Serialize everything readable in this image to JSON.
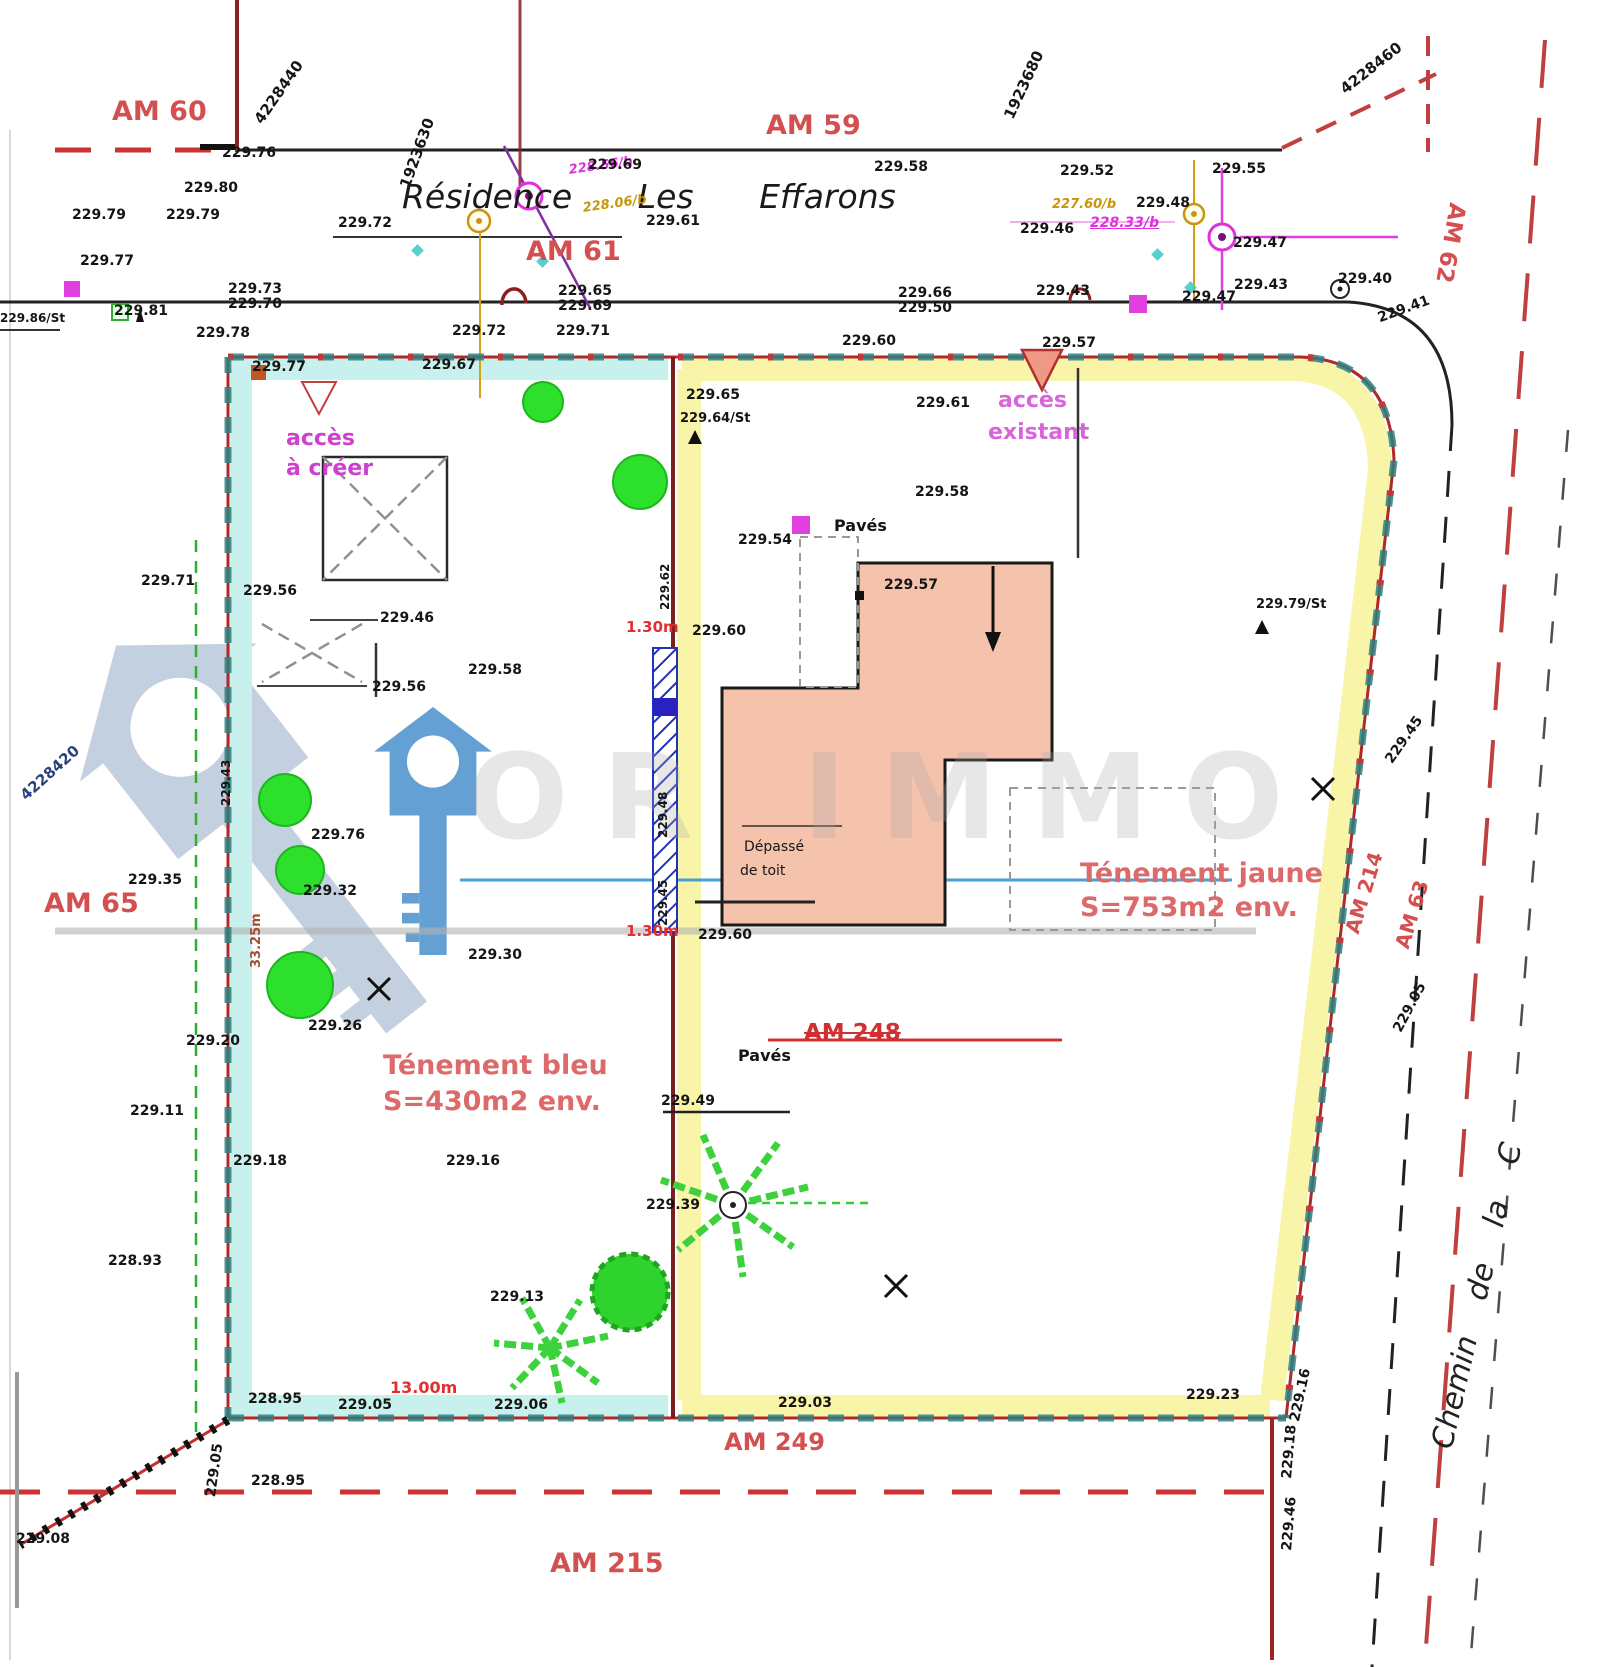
{
  "document": {
    "title": "Plan de division - Résidence Les Effarons"
  },
  "watermark": {
    "text": "OR IMMO"
  },
  "labels": [
    {
      "t": "4228440",
      "x": 252,
      "y": 118,
      "r": -55,
      "s": 15,
      "n": "grid-coordinate"
    },
    {
      "t": "1923630",
      "x": 398,
      "y": 185,
      "r": -70,
      "s": 15,
      "n": "grid-coordinate"
    },
    {
      "t": "1923680",
      "x": 1002,
      "y": 115,
      "r": -65,
      "s": 15,
      "n": "grid-coordinate"
    },
    {
      "t": "4228460",
      "x": 1338,
      "y": 85,
      "r": -38,
      "s": 15,
      "n": "grid-coordinate"
    },
    {
      "t": "4228420",
      "x": 18,
      "y": 792,
      "r": -42,
      "s": 15,
      "c": "#27427a",
      "n": "grid-coordinate"
    },
    {
      "t": "AM 60",
      "x": 112,
      "y": 98,
      "c": "#d45050",
      "s": 27,
      "n": "parcel-label-am60"
    },
    {
      "t": "AM 59",
      "x": 766,
      "y": 112,
      "c": "#d45050",
      "s": 27,
      "n": "parcel-label-am59"
    },
    {
      "t": "AM 61",
      "x": 526,
      "y": 238,
      "c": "#d45050",
      "s": 27,
      "n": "parcel-label-am61"
    },
    {
      "t": "AM 65",
      "x": 44,
      "y": 890,
      "c": "#d45050",
      "s": 27,
      "n": "parcel-label-am65"
    },
    {
      "t": "AM 249",
      "x": 724,
      "y": 1430,
      "c": "#d45050",
      "s": 24,
      "n": "parcel-label-am249"
    },
    {
      "t": "AM 215",
      "x": 550,
      "y": 1550,
      "c": "#d45050",
      "s": 27,
      "n": "parcel-label-am215"
    },
    {
      "t": "AM 62",
      "x": 1468,
      "y": 205,
      "r": 100,
      "c": "#d45050",
      "s": 23,
      "n": "parcel-label-am62"
    },
    {
      "t": "AM 214",
      "x": 1342,
      "y": 930,
      "r": -73,
      "c": "#d45050",
      "s": 20,
      "n": "parcel-label-am214"
    },
    {
      "t": "AM 63",
      "x": 1392,
      "y": 945,
      "r": -73,
      "c": "#d45050",
      "s": 20,
      "n": "parcel-label-am63"
    },
    {
      "t": "AM 248",
      "x": 804,
      "y": 1022,
      "c": "#d03030",
      "s": 23,
      "st": 1,
      "n": "parcel-label-am248-struck"
    },
    {
      "t": "Résidence Les Effarons",
      "x": 402,
      "y": 180,
      "i": 1,
      "s": 33,
      "ws": 55,
      "c": "#1a1a1a",
      "b": 400,
      "n": "street-name"
    },
    {
      "t": "Chemin de la C",
      "x": 1428,
      "y": 1445,
      "r": -77,
      "i": 1,
      "s": 30,
      "ws": 28,
      "c": "#222222",
      "b": 400,
      "n": "road-name"
    },
    {
      "t": "accès",
      "x": 286,
      "y": 428,
      "c": "#d040d0",
      "s": 22,
      "n": "access-to-create-label"
    },
    {
      "t": "à créer",
      "x": 286,
      "y": 458,
      "c": "#d040d0",
      "s": 22,
      "n": "access-to-create-label"
    },
    {
      "t": "accès",
      "x": 998,
      "y": 390,
      "c": "#d966d9",
      "s": 22,
      "n": "access-existing-label"
    },
    {
      "t": "existant",
      "x": 988,
      "y": 422,
      "c": "#d966d9",
      "s": 22,
      "n": "access-existing-label"
    },
    {
      "t": "Ténement jaune",
      "x": 1080,
      "y": 860,
      "c": "#dd6a6a",
      "s": 27,
      "n": "yellow-parcel-title"
    },
    {
      "t": "S=753m2 env.",
      "x": 1080,
      "y": 894,
      "c": "#dd6a6a",
      "s": 27,
      "n": "yellow-parcel-area"
    },
    {
      "t": "Ténement bleu",
      "x": 383,
      "y": 1052,
      "c": "#dd6a6a",
      "s": 27,
      "n": "blue-parcel-title"
    },
    {
      "t": "S=430m2 env.",
      "x": 383,
      "y": 1088,
      "c": "#dd6a6a",
      "s": 27,
      "n": "blue-parcel-area"
    },
    {
      "t": "Pavés",
      "x": 834,
      "y": 518,
      "s": 16,
      "n": "paving-label"
    },
    {
      "t": "Pavés",
      "x": 738,
      "y": 1048,
      "s": 16,
      "n": "paving-label"
    },
    {
      "t": "Dépassé",
      "x": 744,
      "y": 840,
      "s": 14,
      "b": 400,
      "n": "roof-overhang-label"
    },
    {
      "t": "de toit",
      "x": 740,
      "y": 864,
      "s": 14,
      "b": 400,
      "n": "roof-overhang-label"
    },
    {
      "t": "1.30m",
      "x": 626,
      "y": 620,
      "c": "#e03030",
      "s": 15,
      "n": "dimension-label"
    },
    {
      "t": "1.30m",
      "x": 626,
      "y": 924,
      "c": "#e03030",
      "s": 15,
      "n": "dimension-label"
    },
    {
      "t": "13.00m",
      "x": 390,
      "y": 1380,
      "c": "#e03030",
      "s": 16,
      "n": "dimension-label"
    },
    {
      "t": "33.25m",
      "x": 250,
      "y": 968,
      "r": -90,
      "c": "#a05030",
      "s": 13,
      "n": "dimension-label"
    },
    {
      "t": "228.56/b",
      "x": 568,
      "y": 164,
      "r": -8,
      "c": "#e030e0",
      "s": 13,
      "i": 1,
      "n": "utility-label"
    },
    {
      "t": "228.06/b",
      "x": 582,
      "y": 202,
      "r": -8,
      "c": "#c8960c",
      "s": 13,
      "i": 1,
      "n": "utility-label"
    },
    {
      "t": "227.60/b",
      "x": 1052,
      "y": 198,
      "c": "#c8960c",
      "s": 13,
      "i": 1,
      "n": "utility-label"
    },
    {
      "t": "228.33/b",
      "x": 1090,
      "y": 216,
      "c": "#e030e0",
      "s": 14,
      "i": 1,
      "u": 1,
      "n": "utility-label"
    },
    {
      "t": "229.76",
      "x": 222,
      "y": 146
    },
    {
      "t": "229.80",
      "x": 184,
      "y": 181
    },
    {
      "t": "229.79",
      "x": 72,
      "y": 208
    },
    {
      "t": "229.79",
      "x": 166,
      "y": 208
    },
    {
      "t": "229.72",
      "x": 338,
      "y": 216
    },
    {
      "t": "229.69",
      "x": 588,
      "y": 158
    },
    {
      "t": "229.61",
      "x": 646,
      "y": 214
    },
    {
      "t": "229.58",
      "x": 874,
      "y": 160
    },
    {
      "t": "229.52",
      "x": 1060,
      "y": 164
    },
    {
      "t": "229.55",
      "x": 1212,
      "y": 162
    },
    {
      "t": "229.48",
      "x": 1136,
      "y": 196
    },
    {
      "t": "229.46",
      "x": 1020,
      "y": 222
    },
    {
      "t": "229.47",
      "x": 1233,
      "y": 236
    },
    {
      "t": "229.77",
      "x": 80,
      "y": 254
    },
    {
      "t": "229.73",
      "x": 228,
      "y": 282
    },
    {
      "t": "229.70",
      "x": 228,
      "y": 297
    },
    {
      "t": "229.65",
      "x": 558,
      "y": 284
    },
    {
      "t": "229.69",
      "x": 558,
      "y": 299
    },
    {
      "t": "229.66",
      "x": 898,
      "y": 286
    },
    {
      "t": "229.50",
      "x": 898,
      "y": 301
    },
    {
      "t": "229.43",
      "x": 1036,
      "y": 284
    },
    {
      "t": "229.47",
      "x": 1182,
      "y": 290
    },
    {
      "t": "229.43",
      "x": 1234,
      "y": 278
    },
    {
      "t": "229.40",
      "x": 1338,
      "y": 272
    },
    {
      "t": "229.41",
      "x": 1376,
      "y": 312,
      "r": -20
    },
    {
      "t": "229.86/St",
      "x": 0,
      "y": 312,
      "s": 12
    },
    {
      "t": "229.81",
      "x": 114,
      "y": 304
    },
    {
      "t": "229.78",
      "x": 196,
      "y": 326
    },
    {
      "t": "229.72",
      "x": 452,
      "y": 324
    },
    {
      "t": "229.71",
      "x": 556,
      "y": 324
    },
    {
      "t": "229.60",
      "x": 842,
      "y": 334
    },
    {
      "t": "229.57",
      "x": 1042,
      "y": 336
    },
    {
      "t": "229.77",
      "x": 252,
      "y": 360
    },
    {
      "t": "229.67",
      "x": 422,
      "y": 358
    },
    {
      "t": "229.65",
      "x": 686,
      "y": 388
    },
    {
      "t": "229.64/St",
      "x": 680,
      "y": 412,
      "s": 13
    },
    {
      "t": "229.61",
      "x": 916,
      "y": 396
    },
    {
      "t": "229.58",
      "x": 915,
      "y": 485
    },
    {
      "t": "229.54",
      "x": 738,
      "y": 533
    },
    {
      "t": "229.57",
      "x": 884,
      "y": 578
    },
    {
      "t": "229.79/St",
      "x": 1256,
      "y": 598,
      "s": 13
    },
    {
      "t": "229.71",
      "x": 141,
      "y": 574
    },
    {
      "t": "229.56",
      "x": 243,
      "y": 584
    },
    {
      "t": "229.46",
      "x": 380,
      "y": 611
    },
    {
      "t": "229.58",
      "x": 468,
      "y": 663
    },
    {
      "t": "229.56",
      "x": 372,
      "y": 680
    },
    {
      "t": "229.60",
      "x": 692,
      "y": 624
    },
    {
      "t": "229.76",
      "x": 311,
      "y": 828
    },
    {
      "t": "229.35",
      "x": 128,
      "y": 873
    },
    {
      "t": "229.32",
      "x": 303,
      "y": 884
    },
    {
      "t": "229.30",
      "x": 468,
      "y": 948
    },
    {
      "t": "229.26",
      "x": 308,
      "y": 1019
    },
    {
      "t": "229.20",
      "x": 186,
      "y": 1034
    },
    {
      "t": "229.11",
      "x": 130,
      "y": 1104
    },
    {
      "t": "229.18",
      "x": 233,
      "y": 1154
    },
    {
      "t": "229.16",
      "x": 446,
      "y": 1154
    },
    {
      "t": "228.93",
      "x": 108,
      "y": 1254
    },
    {
      "t": "229.60",
      "x": 698,
      "y": 928
    },
    {
      "t": "229.62",
      "x": 659,
      "y": 610,
      "r": -90,
      "s": 12
    },
    {
      "t": "229.48",
      "x": 657,
      "y": 838,
      "r": -90,
      "s": 12
    },
    {
      "t": "229.45",
      "x": 657,
      "y": 926,
      "r": -90,
      "s": 12
    },
    {
      "t": "229.43",
      "x": 220,
      "y": 806,
      "r": -90,
      "s": 12
    },
    {
      "t": "229.39",
      "x": 646,
      "y": 1198
    },
    {
      "t": "229.49",
      "x": 661,
      "y": 1094
    },
    {
      "t": "229.13",
      "x": 490,
      "y": 1290
    },
    {
      "t": "228.95",
      "x": 248,
      "y": 1392
    },
    {
      "t": "229.05",
      "x": 338,
      "y": 1398
    },
    {
      "t": "229.06",
      "x": 494,
      "y": 1398
    },
    {
      "t": "229.03",
      "x": 778,
      "y": 1396
    },
    {
      "t": "229.23",
      "x": 1186,
      "y": 1388
    },
    {
      "t": "229.05",
      "x": 204,
      "y": 1496,
      "r": -82
    },
    {
      "t": "228.95",
      "x": 251,
      "y": 1474
    },
    {
      "t": "229.08",
      "x": 16,
      "y": 1532
    },
    {
      "t": "229.18",
      "x": 1280,
      "y": 1478,
      "r": -85
    },
    {
      "t": "229.46",
      "x": 1280,
      "y": 1550,
      "r": -85
    },
    {
      "t": "229.45",
      "x": 1383,
      "y": 758,
      "r": -55
    },
    {
      "t": "229.05",
      "x": 1391,
      "y": 1028,
      "r": -62
    },
    {
      "t": "229.16",
      "x": 1288,
      "y": 1420,
      "r": -78
    }
  ]
}
